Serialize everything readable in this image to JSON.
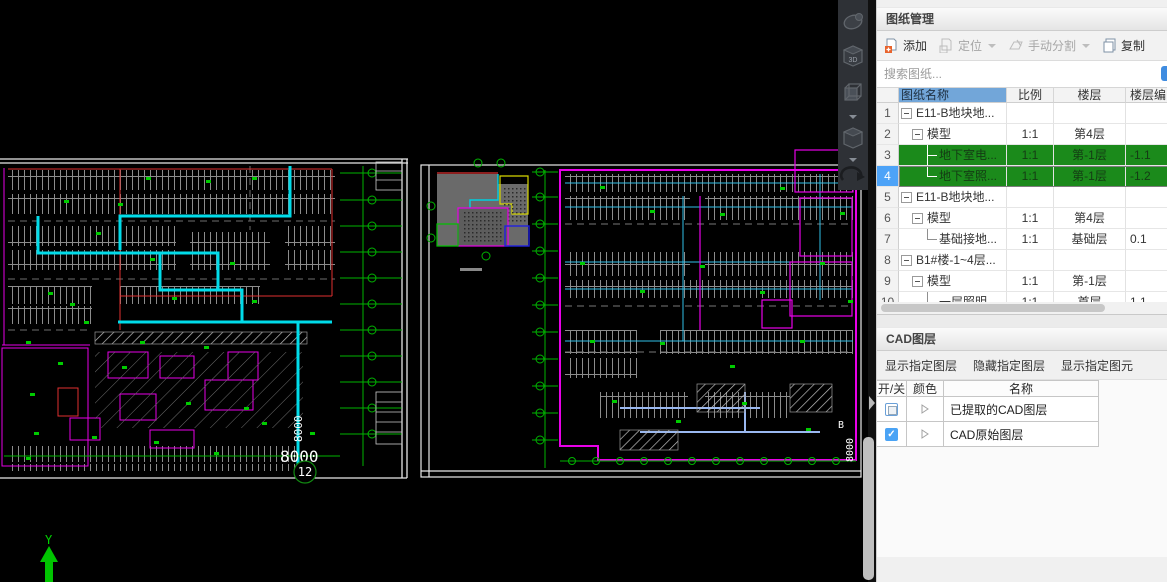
{
  "canvas": {
    "labels": {
      "dim_h": "8000",
      "dim_v_left": "8000",
      "grid_bubble": "12",
      "dim_v_right": "8000",
      "grid_letter": "B",
      "ucs_axis": "Y",
      "view_cube": "3D"
    }
  },
  "view_toolbar": {
    "icons": [
      "orbit",
      "view-cube-3d",
      "wireframe-view",
      "shaded-view",
      "rotate-view"
    ]
  },
  "panel": {
    "sheet_manager": {
      "title": "图纸管理",
      "toolbar": {
        "add": "添加",
        "locate": "定位",
        "manual_split": "手动分割",
        "copy": "复制"
      },
      "search_placeholder": "搜索图纸...",
      "table": {
        "headers": {
          "name": "图纸名称",
          "scale": "比例",
          "floor": "楼层",
          "floor_no": "楼层编..."
        },
        "rows": [
          {
            "num": "1",
            "name": "E11-B地块地...",
            "scale": "",
            "floor": "",
            "floor_no": ""
          },
          {
            "num": "2",
            "name": "模型",
            "scale": "1:1",
            "floor": "第4层",
            "floor_no": ""
          },
          {
            "num": "3",
            "name": "地下室电...",
            "scale": "1:1",
            "floor": "第-1层",
            "floor_no": "-1.1"
          },
          {
            "num": "4",
            "name": "地下室照...",
            "scale": "1:1",
            "floor": "第-1层",
            "floor_no": "-1.2"
          },
          {
            "num": "5",
            "name": "E11-B地块地...",
            "scale": "",
            "floor": "",
            "floor_no": ""
          },
          {
            "num": "6",
            "name": "模型",
            "scale": "1:1",
            "floor": "第4层",
            "floor_no": ""
          },
          {
            "num": "7",
            "name": "基础接地...",
            "scale": "1:1",
            "floor": "基础层",
            "floor_no": "0.1"
          },
          {
            "num": "8",
            "name": "B1#楼-1~4层...",
            "scale": "",
            "floor": "",
            "floor_no": ""
          },
          {
            "num": "9",
            "name": "模型",
            "scale": "1:1",
            "floor": "第-1层",
            "floor_no": ""
          },
          {
            "num": "10",
            "name": "一层照明",
            "scale": "1:1",
            "floor": "首层",
            "floor_no": "1.1"
          }
        ]
      }
    },
    "cad_layers": {
      "title": "CAD图层",
      "buttons": [
        "显示指定图层",
        "隐藏指定图层",
        "显示指定图元"
      ],
      "table": {
        "headers": {
          "toggle": "开/关",
          "color": "颜色",
          "name": "名称"
        },
        "rows": [
          {
            "name": "已提取的CAD图层",
            "checked": "partial"
          },
          {
            "name": "CAD原始图层",
            "checked": "checked"
          }
        ]
      }
    }
  },
  "colors": {
    "green_row": "#1b8a1b",
    "selected_row_number": "#4da3f8",
    "name_header": "#72a6d9",
    "cad_magenta": "#e800e8",
    "cad_cyan": "#00dcea",
    "cad_green": "#00c400",
    "cad_red": "#e03030"
  }
}
